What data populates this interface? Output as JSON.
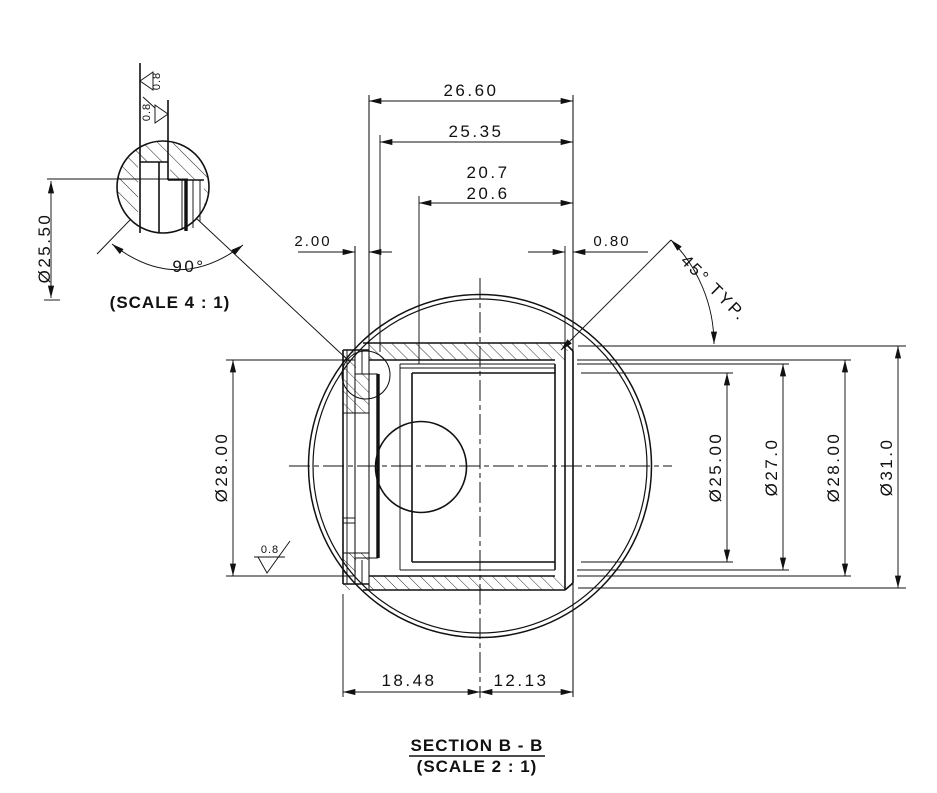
{
  "drawing": {
    "section_title": "SECTION B - B",
    "section_scale": "(SCALE 2 : 1)",
    "detail_scale": "(SCALE 4 : 1)",
    "dims": {
      "overall_width": "26.60",
      "inner_width": "25.35",
      "bore_depth_upper": "20.7",
      "bore_depth_lower": "20.6",
      "rim_width": "2.00",
      "chamfer_width": "0.80",
      "chamfer_angle": "45° TYP.",
      "left_length": "18.48",
      "right_length": "12.13",
      "dia_bore": "Ø25.00",
      "dia_counterbore": "Ø27.0",
      "dia_step": "Ø28.00",
      "dia_outer": "Ø31.0",
      "dia_rim": "Ø28.00",
      "dia_groove": "Ø25.50",
      "groove_angle": "90°"
    },
    "surface_finish": {
      "groove_left": "0.8",
      "groove_right": "0.8",
      "bottom_face": "0.8"
    }
  }
}
